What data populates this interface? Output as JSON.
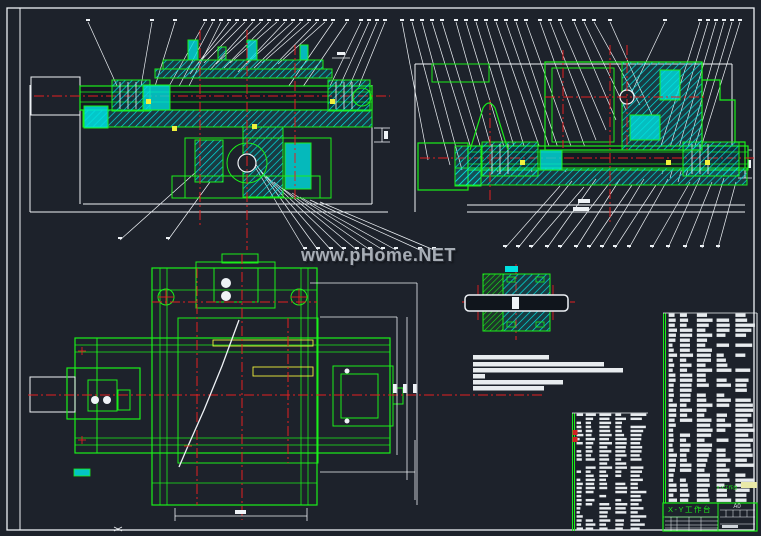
{
  "document": {
    "type": "CAD assembly drawing screenshot",
    "sheet": "engineering drawing with two section views, one plan view, one shaft detail, parts lists and title block"
  },
  "watermark": {
    "text": "www.pHome.NET"
  },
  "title_block": {
    "part_name": "X-Y工作台",
    "sheet_size": "A0",
    "bom_label": "X-Y工作台"
  },
  "views": {
    "front_section": "front cross-section of X-Y table (top left)",
    "side_section": "side cross-section of X-Y table (top right)",
    "plan": "plan view of X-Y table (bottom left)",
    "shaft_detail": "shaft bearing detail section (middle right)"
  },
  "tables": {
    "left_bom_rows": 29,
    "right_bom_rows": 38,
    "text_legible": false
  },
  "technical_notes": {
    "lines": 6,
    "text_legible": false
  },
  "colors": {
    "background": "#1d222b",
    "outline_green": "#1aef1a",
    "hatch_cyan": "#00e0e0",
    "centerline_red": "#e32020",
    "line_white": "#eef2f6",
    "accent_yellow": "#f0f03c",
    "table_cell": "#e8ecef",
    "bom_highlight": "#e9e9a8",
    "watermark_gray": "#a7adb5"
  }
}
